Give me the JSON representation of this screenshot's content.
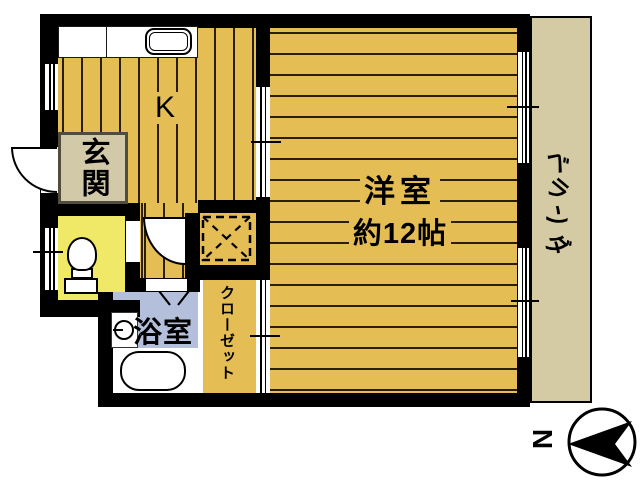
{
  "title": "apartment-floor-plan",
  "colors": {
    "wall": "#000000",
    "floor-gold": "#e4bd55",
    "plank-line": "#2b1f00",
    "genkan-fill": "#d2c9a9",
    "genkan-border": "#4f4d3c",
    "toilet-yellow": "#f0e967",
    "bath-blue": "#b4c0db",
    "veranda-beige": "#d4caa3"
  },
  "rooms": {
    "kitchen": {
      "label": "K"
    },
    "genkan": {
      "label": "玄関"
    },
    "bathroom": {
      "label": "浴室"
    },
    "closet": {
      "label": "クローゼット"
    },
    "western": {
      "label": "洋室",
      "size": "約12帖"
    },
    "veranda": {
      "label": "ベランダ"
    }
  },
  "compass": {
    "north": "N"
  },
  "fixtures": [
    "kitchen-sink",
    "kitchen-counter",
    "toilet",
    "bathtub",
    "washing-machine",
    "entrance-door-arc",
    "hall-door-arc",
    "bath-folding-door",
    "refrigerator-space",
    "window",
    "sliding-door",
    "compass-north-arrow"
  ]
}
